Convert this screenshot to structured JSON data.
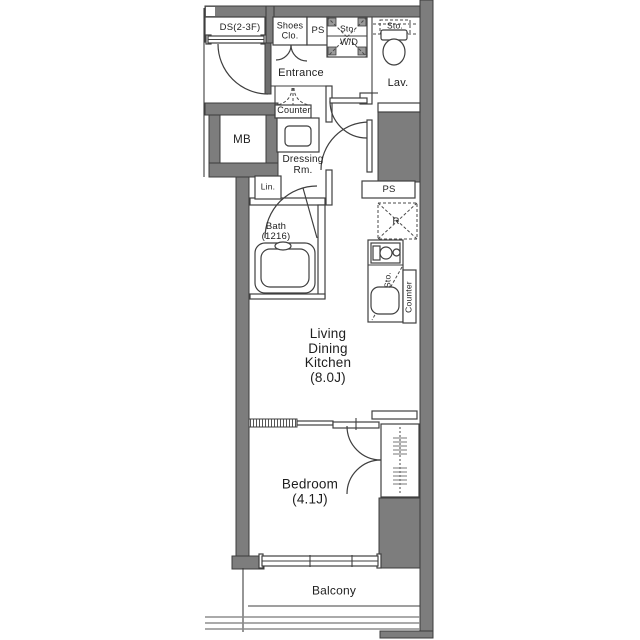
{
  "colors": {
    "wall_fill": "#7d7d7d",
    "wall_stroke": "#3c3c3c",
    "line": "#3f3f3f",
    "text": "#1e1e1e",
    "background": "#ffffff",
    "railing": "#8d8d8d",
    "door_leaf": "#6e6e6e",
    "washer_corner": "#9a9a9a"
  },
  "floorplan": {
    "upper": {
      "duct_space": "DS(2-3F)",
      "shoes_closet": "Shoes\nClo.",
      "pipe_space": "PS",
      "storage_above_washer": "Sto.",
      "washer_dryer": "W/D",
      "lavatory_storage": "Sto.",
      "lavatory": "Lav.",
      "entrance": "Entrance",
      "entrance_counter": "Counter",
      "meter_box": "MB"
    },
    "middle": {
      "dressing_room": "Dressing\nRm.",
      "linen": "Lin.",
      "bath": "Bath\n(1216)",
      "pipe_space": "PS",
      "refrigerator": "R",
      "kitchen_storage": "Sto.",
      "kitchen_counter": "Counter"
    },
    "rooms": {
      "living_dining_kitchen": "Living\nDining\nKitchen\n(8.0J)",
      "bedroom": "Bedroom\n(4.1J)",
      "balcony": "Balcony"
    }
  }
}
